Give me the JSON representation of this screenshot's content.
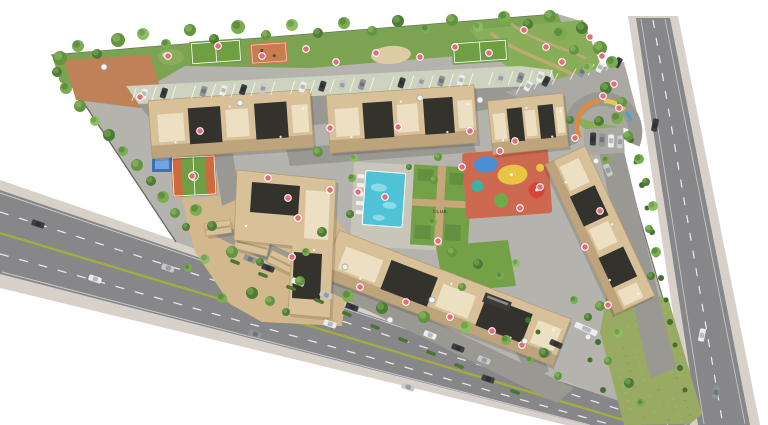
{
  "meta": {
    "title": "Residential township masterplan - aerial site plan render"
  },
  "labels": {
    "club": "CLUB"
  },
  "palette": {
    "bg": "#ffffff",
    "asphalt": "#87878a",
    "sidewalk": "#d8d1ca",
    "median": "#a3ab3f",
    "site": "#b4b3ae",
    "iroad": "#9a9892",
    "lot": "#a9a8a2",
    "stall": "#ced3c0",
    "greenstrip": "#7ca351",
    "park": "#88ae5a",
    "lawn": "#74a148",
    "lawnDark": "#639040",
    "field": "#99aa62",
    "fieldDot": "#aab873",
    "fieldDot2": "#879a52",
    "sand": "#d3b88e",
    "sandLight": "#dccba3",
    "path": "#c7a77a",
    "plaza": "#c08158",
    "courtGreen": "#6f9e43",
    "courtOrange": "#d06a3e",
    "courtClay": "#c97c4f",
    "courtBlue": "#3f6fc0",
    "courtBlueLight": "#74a4df",
    "pool": "#4fc2d5",
    "poolLight": "#a5e4ec",
    "deck": "#c8c5bb",
    "playBase": "#cc6950",
    "playYellow": "#e8c644",
    "playBlue": "#4a8fd6",
    "playRed": "#d64536",
    "playGreen": "#6cad49",
    "playTeal": "#3eb0a5",
    "tree0": "#4e7c36",
    "tree1": "#639441",
    "tree2": "#7bad52",
    "tree3": "#8fbd63",
    "bush": "#436f2f",
    "hedge": "#4c7433",
    "markerPink": "#e66b7c",
    "markerWhite": "#f6f4f0",
    "wall": "#6b685e",
    "bldg": "#d8c099",
    "bldgLight": "#ecdfc2",
    "bldgShade": "#a98d64",
    "roofDark": "#33322c",
    "bldgEdge": "#b49a70",
    "gate": "#3b3a34",
    "carDark": "#3c3e41",
    "carWhite": "#ebecec",
    "carMid": "#90959a",
    "carSilver": "#c6c8ca",
    "arcOrange": "#e08a3c",
    "arcYellow": "#e9c84d",
    "arcTeal": "#4fa3c2"
  },
  "buildings": [
    [
      231,
      124,
      162,
      58,
      -4,
      0
    ],
    [
      402,
      119,
      148,
      58,
      -4,
      0
    ],
    [
      528,
      124,
      76,
      54,
      -6,
      0
    ],
    [
      600,
      230,
      165,
      44,
      65,
      0
    ],
    [
      446,
      298,
      248,
      50,
      21,
      0
    ],
    [
      218,
      228,
      26,
      13,
      -8,
      1
    ],
    [
      252,
      245,
      34,
      15,
      14,
      1
    ],
    [
      282,
      262,
      28,
      13,
      26,
      1
    ],
    [
      306,
      243,
      20,
      11,
      4,
      1
    ]
  ],
  "stalls": {
    "rows": [
      {
        "from": [
          132,
          101
        ],
        "to": [
          548,
          83
        ],
        "count": 22,
        "len": 14,
        "angle": -72
      },
      {
        "from": [
          516,
          94
        ],
        "to": [
          624,
          66
        ],
        "count": 7,
        "len": 13,
        "angle": -62
      }
    ]
  },
  "cars": [
    [
      38,
      224,
      19,
      0
    ],
    [
      168,
      268,
      19,
      3
    ],
    [
      330,
      324,
      19,
      1
    ],
    [
      488,
      379,
      19,
      0
    ],
    [
      95,
      279,
      19,
      1
    ],
    [
      255,
      334,
      19,
      2
    ],
    [
      408,
      387,
      19,
      3
    ],
    [
      655,
      125,
      101,
      0
    ],
    [
      702,
      335,
      101,
      1
    ],
    [
      716,
      392,
      101,
      2
    ],
    [
      593,
      139,
      -88,
      0
    ],
    [
      602,
      140,
      -88,
      2
    ],
    [
      611,
      141,
      -88,
      1
    ],
    [
      620,
      142,
      -88,
      3
    ],
    [
      250,
      259,
      21,
      2
    ],
    [
      268,
      268,
      21,
      0
    ],
    [
      298,
      282,
      21,
      1
    ],
    [
      326,
      295,
      21,
      3
    ],
    [
      352,
      307,
      21,
      0
    ],
    [
      430,
      335,
      21,
      1
    ],
    [
      458,
      348,
      21,
      0
    ],
    [
      484,
      360,
      21,
      3
    ],
    [
      556,
      344,
      24,
      0
    ],
    [
      545,
      352,
      24,
      2
    ],
    [
      608,
      170,
      66,
      3
    ],
    [
      586,
      329,
      24,
      1,
      24
    ]
  ],
  "hedges": [
    [
      235,
      262
    ],
    [
      263,
      275
    ],
    [
      291,
      288
    ],
    [
      319,
      301
    ],
    [
      347,
      314
    ],
    [
      375,
      327
    ],
    [
      403,
      340
    ],
    [
      431,
      353
    ],
    [
      459,
      366
    ],
    [
      487,
      379
    ],
    [
      515,
      392
    ]
  ],
  "bushes": [
    [
      631,
      140,
      3
    ],
    [
      636,
      162,
      2.5
    ],
    [
      642,
      185,
      3
    ],
    [
      647,
      208,
      2.5
    ],
    [
      652,
      232,
      3
    ],
    [
      656,
      255,
      2.5
    ],
    [
      661,
      278,
      3
    ],
    [
      666,
      300,
      2.5
    ],
    [
      670,
      322,
      3
    ],
    [
      675,
      345,
      2.5
    ],
    [
      680,
      368,
      3
    ],
    [
      685,
      390,
      2.5
    ],
    [
      598,
      342,
      3
    ],
    [
      590,
      360,
      2.5
    ],
    [
      603,
      390,
      3
    ],
    [
      528,
      320,
      3
    ],
    [
      538,
      332,
      2.5
    ]
  ],
  "trees": [
    [
      60,
      58,
      7,
      1
    ],
    [
      78,
      46,
      6,
      2
    ],
    [
      97,
      54,
      5,
      0
    ],
    [
      118,
      40,
      7,
      1
    ],
    [
      143,
      34,
      6,
      3
    ],
    [
      166,
      44,
      5,
      2
    ],
    [
      190,
      30,
      6,
      1
    ],
    [
      214,
      39,
      5,
      0
    ],
    [
      238,
      27,
      7,
      2
    ],
    [
      266,
      35,
      5,
      1
    ],
    [
      292,
      25,
      6,
      3
    ],
    [
      318,
      33,
      5,
      0
    ],
    [
      344,
      23,
      6,
      2
    ],
    [
      372,
      31,
      5,
      1
    ],
    [
      398,
      21,
      6,
      0
    ],
    [
      426,
      29,
      5,
      2
    ],
    [
      452,
      20,
      6,
      1
    ],
    [
      478,
      27,
      5,
      3
    ],
    [
      504,
      17,
      6,
      2
    ],
    [
      528,
      24,
      5,
      0
    ],
    [
      550,
      16,
      6,
      1
    ],
    [
      560,
      34,
      7,
      2
    ],
    [
      582,
      28,
      6,
      0
    ],
    [
      600,
      48,
      7,
      1
    ],
    [
      588,
      68,
      5,
      3
    ],
    [
      612,
      62,
      6,
      2
    ],
    [
      606,
      88,
      6,
      0
    ],
    [
      622,
      102,
      5,
      1
    ],
    [
      617,
      118,
      6,
      2
    ],
    [
      599,
      121,
      5,
      0
    ],
    [
      574,
      50,
      5,
      1
    ],
    [
      57,
      72,
      5,
      0
    ],
    [
      66,
      88,
      6,
      2
    ],
    [
      80,
      106,
      6,
      1
    ],
    [
      95,
      121,
      5,
      3
    ],
    [
      109,
      135,
      6,
      0
    ],
    [
      123,
      151,
      5,
      2
    ],
    [
      137,
      165,
      6,
      1
    ],
    [
      151,
      181,
      5,
      0
    ],
    [
      163,
      197,
      6,
      2
    ],
    [
      175,
      213,
      5,
      1
    ],
    [
      186,
      227,
      4,
      0
    ],
    [
      196,
      210,
      6,
      2
    ],
    [
      212,
      226,
      5,
      0
    ],
    [
      232,
      252,
      6,
      1
    ],
    [
      205,
      259,
      5,
      3
    ],
    [
      252,
      293,
      6,
      0
    ],
    [
      222,
      298,
      5,
      2
    ],
    [
      270,
      301,
      5,
      1
    ],
    [
      286,
      312,
      4,
      0
    ],
    [
      188,
      268,
      4,
      2
    ],
    [
      318,
      152,
      5,
      1
    ],
    [
      322,
      232,
      5,
      0
    ],
    [
      306,
      252,
      4,
      2
    ],
    [
      354,
      158,
      4,
      3
    ],
    [
      438,
      157,
      4,
      1
    ],
    [
      352,
      178,
      4,
      2
    ],
    [
      350,
      214,
      4,
      0
    ],
    [
      434,
      180,
      4,
      1
    ],
    [
      433,
      222,
      4,
      2
    ],
    [
      409,
      167,
      3,
      0
    ],
    [
      452,
      252,
      5,
      1
    ],
    [
      478,
      264,
      5,
      0
    ],
    [
      500,
      276,
      4,
      2
    ],
    [
      516,
      263,
      4,
      3
    ],
    [
      462,
      287,
      4,
      1
    ],
    [
      348,
      296,
      6,
      2
    ],
    [
      382,
      308,
      6,
      0
    ],
    [
      424,
      317,
      6,
      1
    ],
    [
      466,
      327,
      6,
      3
    ],
    [
      506,
      340,
      5,
      2
    ],
    [
      544,
      353,
      5,
      0
    ],
    [
      300,
      281,
      5,
      1
    ],
    [
      260,
      262,
      4,
      0
    ],
    [
      628,
      136,
      5,
      1
    ],
    [
      639,
      159,
      5,
      2
    ],
    [
      646,
      182,
      4,
      0
    ],
    [
      653,
      206,
      5,
      3
    ],
    [
      649,
      229,
      4,
      1
    ],
    [
      656,
      252,
      5,
      2
    ],
    [
      651,
      276,
      4,
      0
    ],
    [
      606,
      160,
      4,
      2
    ],
    [
      600,
      306,
      5,
      1
    ],
    [
      588,
      317,
      4,
      0
    ],
    [
      574,
      300,
      4,
      2
    ],
    [
      618,
      333,
      5,
      3
    ],
    [
      608,
      361,
      4,
      1
    ],
    [
      629,
      383,
      5,
      0
    ],
    [
      641,
      403,
      4,
      2
    ],
    [
      570,
      120,
      4,
      0
    ],
    [
      558,
      376,
      4,
      1
    ],
    [
      530,
      360,
      3.5,
      2
    ]
  ],
  "markers": {
    "pink": [
      [
        140,
        97
      ],
      [
        168,
        56
      ],
      [
        218,
        46
      ],
      [
        262,
        56
      ],
      [
        306,
        49
      ],
      [
        336,
        62
      ],
      [
        376,
        53
      ],
      [
        420,
        57
      ],
      [
        455,
        47
      ],
      [
        489,
        53
      ],
      [
        524,
        30
      ],
      [
        546,
        47
      ],
      [
        562,
        62
      ],
      [
        590,
        37
      ],
      [
        602,
        56
      ],
      [
        614,
        84
      ],
      [
        619,
        108
      ],
      [
        200,
        131
      ],
      [
        330,
        128
      ],
      [
        398,
        127
      ],
      [
        470,
        131
      ],
      [
        515,
        141
      ],
      [
        603,
        96
      ],
      [
        268,
        178
      ],
      [
        288,
        198
      ],
      [
        298,
        218
      ],
      [
        330,
        190
      ],
      [
        358,
        192
      ],
      [
        385,
        197
      ],
      [
        438,
        241
      ],
      [
        520,
        208
      ],
      [
        540,
        187
      ],
      [
        462,
        167
      ],
      [
        500,
        151
      ],
      [
        192,
        176
      ],
      [
        292,
        257
      ],
      [
        360,
        287
      ],
      [
        406,
        302
      ],
      [
        450,
        317
      ],
      [
        492,
        331
      ],
      [
        522,
        345
      ],
      [
        585,
        247
      ],
      [
        600,
        211
      ],
      [
        575,
        138
      ],
      [
        608,
        305
      ]
    ],
    "white": [
      [
        104,
        67
      ],
      [
        240,
        103
      ],
      [
        420,
        98
      ],
      [
        480,
        100
      ],
      [
        345,
        267
      ],
      [
        390,
        320
      ],
      [
        432,
        300
      ],
      [
        525,
        341
      ],
      [
        596,
        161
      ],
      [
        588,
        337
      ]
    ]
  },
  "field_quad": {
    "top": [
      [
        606,
        292
      ],
      [
        670,
        300
      ]
    ],
    "bottom": [
      [
        622,
        422
      ],
      [
        692,
        422
      ]
    ],
    "count": 70
  }
}
